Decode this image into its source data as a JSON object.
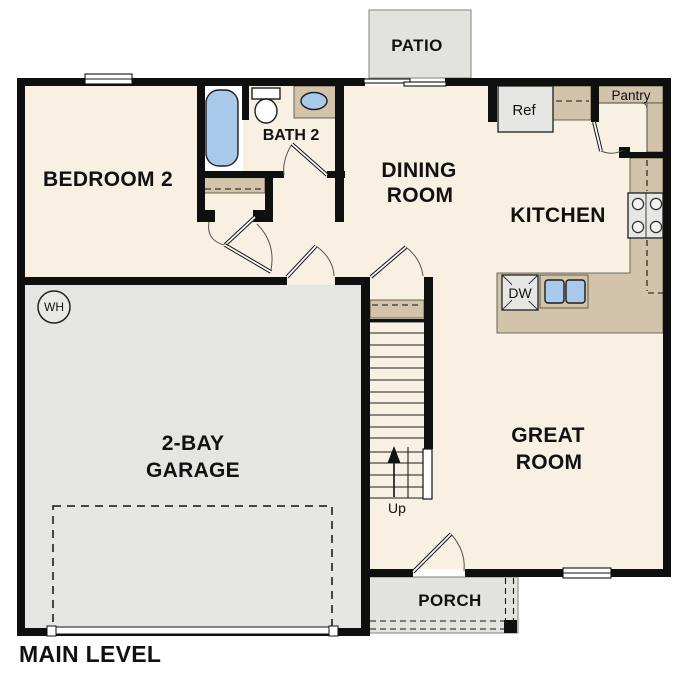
{
  "title": "MAIN LEVEL",
  "rooms": {
    "bedroom2": {
      "label": "BEDROOM 2"
    },
    "bath2": {
      "label": "BATH 2"
    },
    "dining": {
      "line1": "DINING",
      "line2": "ROOM"
    },
    "kitchen": {
      "label": "KITCHEN"
    },
    "great_room": {
      "line1": "GREAT",
      "line2": "ROOM"
    },
    "garage": {
      "line1": "2-BAY",
      "line2": "GARAGE"
    },
    "patio": {
      "label": "PATIO"
    },
    "porch": {
      "label": "PORCH"
    }
  },
  "fixtures": {
    "refrigerator": "Ref",
    "dishwasher": "DW",
    "pantry": "Pantry",
    "water_heater": "WH",
    "stairs_direction": "Up"
  },
  "colors": {
    "wall": "#0f0f0f",
    "floor": "#f7f0e3",
    "garage_floor": "#e5e5e3",
    "exterior_concrete": "#e2e2df",
    "counter_tan": "#d2c4aa",
    "fixture_blue": "#a9c9ea",
    "appliance_gray": "#e6e6e4",
    "background": "#ffffff"
  }
}
